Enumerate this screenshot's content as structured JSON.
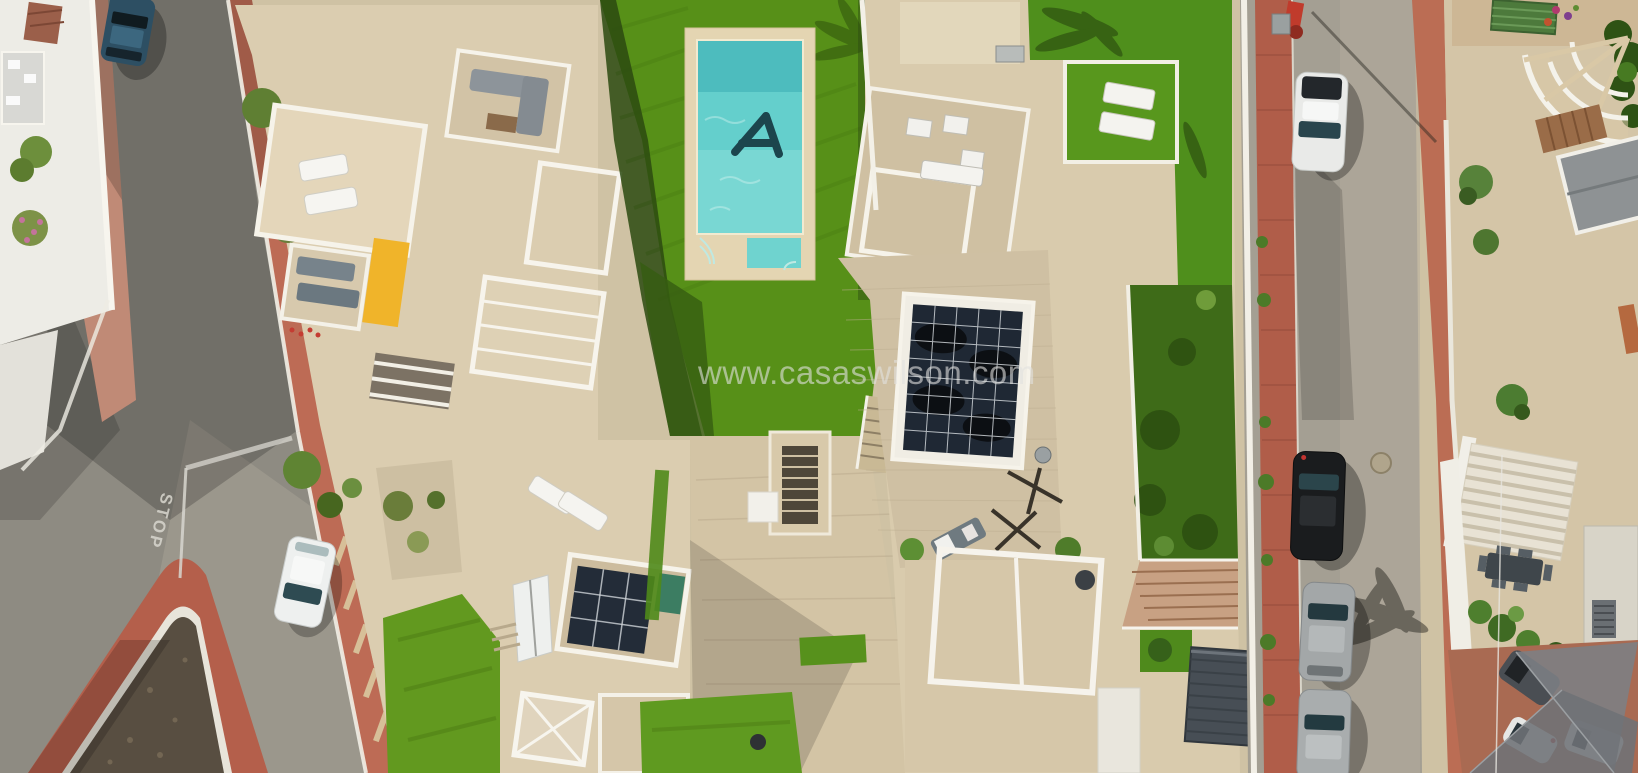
{
  "watermark": {
    "text": "www.casaswilson.com"
  },
  "road_markings": {
    "stop": "STOP"
  },
  "palette": {
    "ground_tan": "#cfc2a4",
    "grass_bright": "#579018",
    "grass_shadow": "#2c4a11",
    "lawn_right": "#4f8f1c",
    "pool_water": "#64cfcc",
    "pool_water_light": "#8adfd8",
    "pool_logo": "#1c454d",
    "pool_deck": "#e4d5b2",
    "terrace_beige": "#dbcdb0",
    "roof_tile": "#cfc0a3",
    "wall_white": "#f2efe6",
    "asphalt_left": "#8e8b82",
    "asphalt_right": "#a49f93",
    "sidewalk_red": "#b05d49",
    "sidewalk_pink": "#c08a76",
    "island_brick": "#b45f4b",
    "island_gravel": "#584e41",
    "solar_panel": "#1f2834",
    "shed_gray": "#474e55",
    "terracotta_patio": "#a96a52",
    "shade_sail": "#7c8084",
    "awning_yellow": "#f0b42a",
    "car_white": "#e9eae8",
    "car_black": "#1a1c1e",
    "car_silver": "#a3a7a8",
    "car_blue": "#2d4f63",
    "bench_green": "#4d7a3c"
  }
}
